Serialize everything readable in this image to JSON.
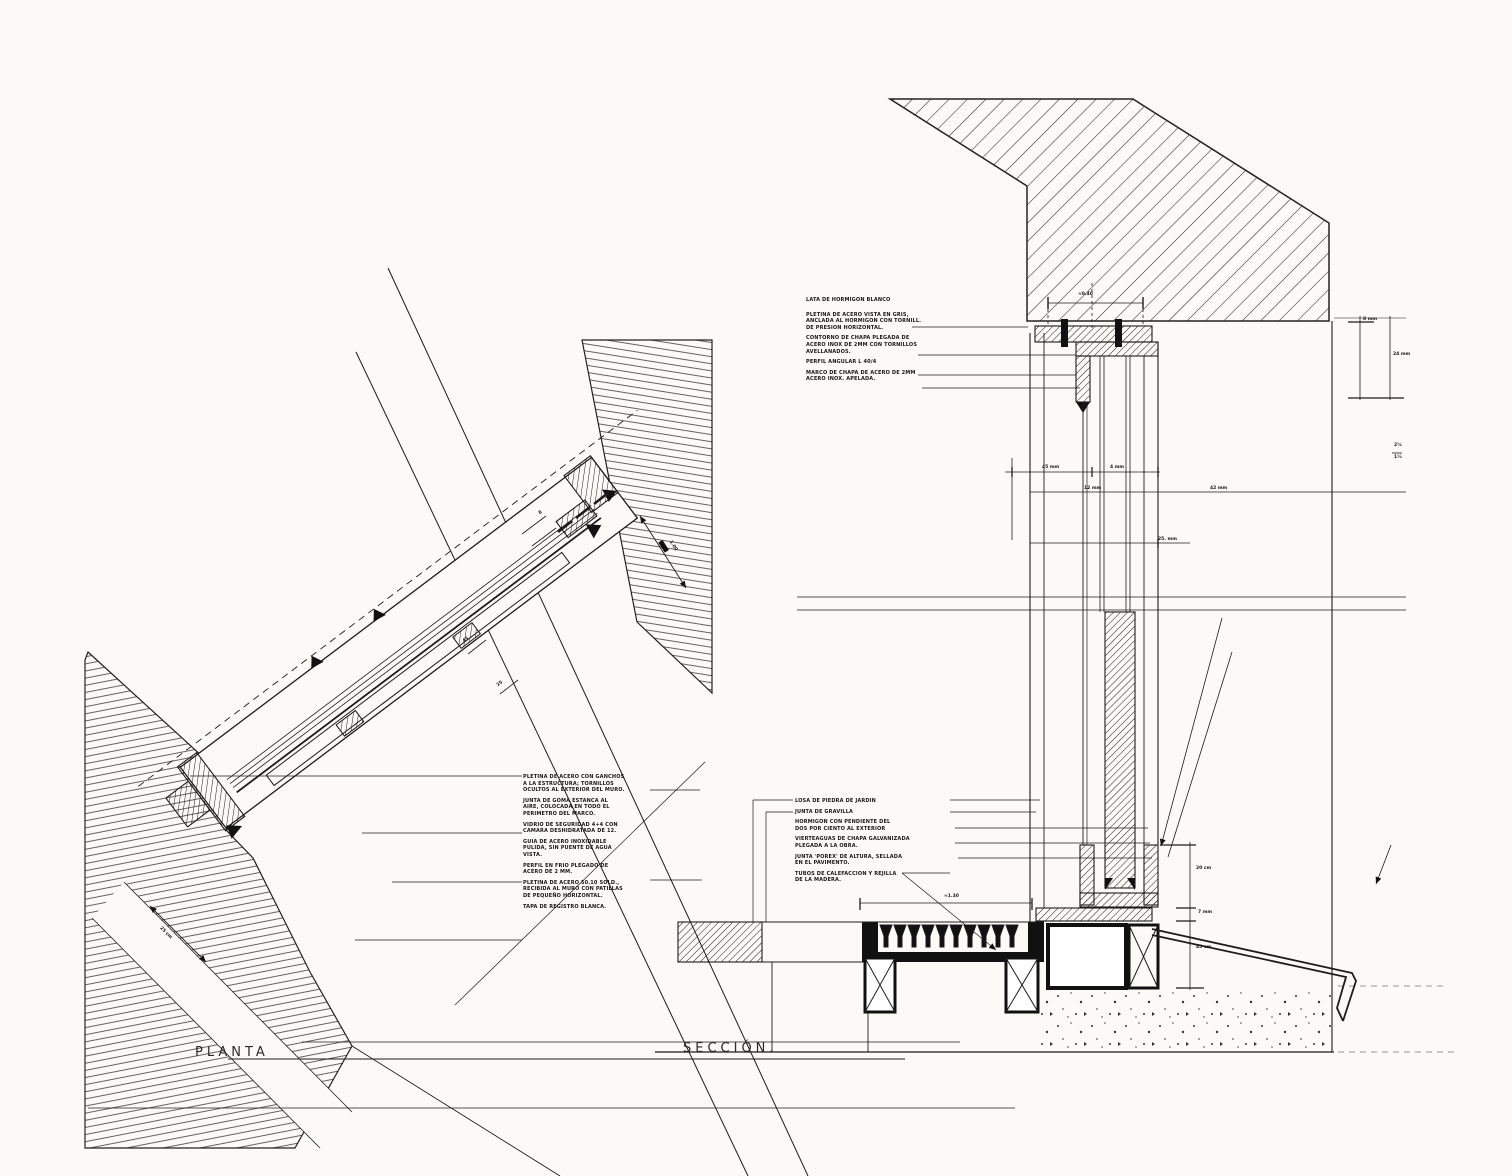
{
  "page": {
    "background": "#fbfaf7",
    "ink": "#1c1c1c"
  },
  "labels": {
    "planta": "PLANTA",
    "seccion": "SECCIÓN."
  },
  "annotations": {
    "plan_notes": [
      "PLETINA DE ACERO CON GANCHOS",
      "A LA ESTRUCTURA; TORNILLOS",
      "OCULTOS AL EXTERIOR DEL MURO.",
      "",
      "JUNTA DE GOMA ESTANCA AL",
      "AIRE, COLOCADA EN TODO EL",
      "PERIMETRO DEL MARCO.",
      "",
      "VIDRIO DE SEGURIDAD 4+4 CON",
      "CAMARA DESHIDRATADA DE 12.",
      "",
      "GUIA DE ACERO INOXIDABLE",
      "PULIDA, SIN PUENTE DE AGUA",
      "VISTA.",
      "",
      "PERFIL EN FRIO PLEGADO DE",
      "ACERO DE 2 MM.",
      "",
      "PLETINA DE ACERO 50.10 SOLD.,",
      "RECIBIDA AL MURO CON PATILLAS",
      "DE PEQUEÑO HORIZONTAL.",
      "",
      "TAPA DE REGISTRO BLANCA."
    ],
    "section_head_notes": [
      "LATA DE HORMIGON BLANCO",
      "",
      "",
      "PLETINA DE ACERO VISTA EN GRIS,",
      "ANCLADA AL HORMIGON CON TORNILL.",
      "DE PRESION HORIZONTAL.",
      "",
      "CONTORNO DE CHAPA PLEGADA DE",
      "ACERO INOX DE 2MM CON TORNILLOS",
      "AVELLANADOS.",
      "",
      "PERFIL ANGULAR L 40/4",
      "",
      "MARCO DE CHAPA DE ACERO DE 2MM",
      "ACERO INOX. APELADA."
    ],
    "section_sill_notes": [
      "LOSA DE PIEDRA DE JARDIN",
      "",
      "JUNTA DE GRAVILLA",
      "",
      "HORMIGON CON PENDIENTE DEL",
      "DOS POR CIENTO AL EXTERIOR",
      "",
      "VIERTEAGUAS DE CHAPA GALVANIZADA",
      "PLEGADA A LA OBRA.",
      "",
      "JUNTA 'POREX' DE ALTURA, SELLADA",
      "EN EL PAVIMENTO.",
      "",
      "TUBOS DE CALEFACCION Y REJILLA",
      "DE LA MADERA."
    ]
  },
  "dims": {
    "d_top": "≈0.40",
    "d_r1": "8 mm",
    "d_r2": "24 mm",
    "d_frac_t": "2½",
    "d_frac_b": "1½",
    "d_45": "45 mm",
    "d_4": "4 mm",
    "d_12": "12 mm",
    "d_42": "42 mm",
    "d_25": "25. mm",
    "d_s20": "20 cm",
    "d_s7": "7 mm",
    "d_s45": "45 cm",
    "d_g": "≈1.30",
    "d_p25": "25 cm",
    "d_p100": "1.00",
    "d_p8": "8",
    "d_p45": "45",
    "d_p25b": "25"
  }
}
